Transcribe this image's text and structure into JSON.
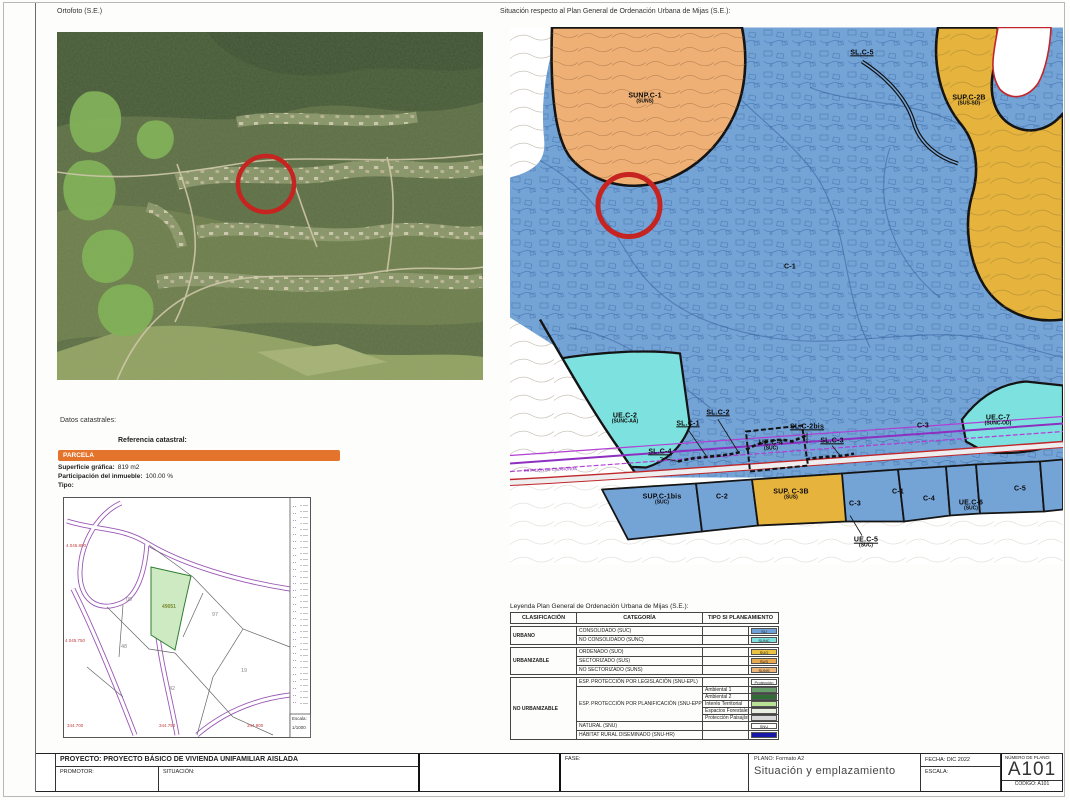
{
  "page": {
    "ortho_caption": "Ortofoto (S.E.)",
    "pgou_caption": "Situación respecto al Plan General de Ordenación Urbana de Mijas (S.E.):"
  },
  "pgou": {
    "corridor_text": "ESTACIÓN DE CALAHONDA",
    "colors": {
      "urban_blue": "#74a3d6",
      "suns_orange": "#efb076",
      "sus_gold": "#e6b33c",
      "sunc_cyan": "#7de2df",
      "marker_red": "#c62420",
      "corridor_purple": "#8d2fc0"
    },
    "labels": [
      {
        "t": "SUNP.C-1",
        "s": "(SUNS)",
        "x": 135,
        "y": 72
      },
      {
        "t": "SL.C-5",
        "x": 352,
        "y": 26,
        "u": 1
      },
      {
        "t": "SUP.C-2B",
        "s": "(SUS-SD)",
        "x": 459,
        "y": 74
      },
      {
        "t": "C-1",
        "x": 280,
        "y": 240
      },
      {
        "t": "UE.C-2",
        "s": "(SUNC-AA)",
        "x": 115,
        "y": 392
      },
      {
        "t": "SL.C-1",
        "x": 178,
        "y": 397,
        "u": 1
      },
      {
        "t": "SL.C-2",
        "x": 208,
        "y": 386,
        "u": 1
      },
      {
        "t": "SL.C-2bis",
        "x": 297,
        "y": 400,
        "u": 1
      },
      {
        "t": "SL.C-3",
        "x": 322,
        "y": 414,
        "u": 1
      },
      {
        "t": "SL.C-4",
        "x": 150,
        "y": 425,
        "u": 1
      },
      {
        "t": "UE.C-4",
        "s": "(SUC)",
        "x": 261,
        "y": 419
      },
      {
        "t": "C-3",
        "x": 413,
        "y": 399
      },
      {
        "t": "UE.C-7",
        "s": "(SUNC-OD)",
        "x": 488,
        "y": 394
      },
      {
        "t": "SUP.C-1bis",
        "s": "(SUC)",
        "x": 152,
        "y": 473
      },
      {
        "t": "C-2",
        "x": 212,
        "y": 470
      },
      {
        "t": "SUP. C-3B",
        "s": "(SUS)",
        "x": 281,
        "y": 468
      },
      {
        "t": "C-3",
        "x": 345,
        "y": 477
      },
      {
        "t": "C-1",
        "x": 388,
        "y": 465
      },
      {
        "t": "C-4",
        "x": 419,
        "y": 472
      },
      {
        "t": "UE.C-6",
        "s": "(SUC)",
        "x": 461,
        "y": 479
      },
      {
        "t": "C-5",
        "x": 510,
        "y": 462
      },
      {
        "t": "UE.C-5",
        "s": "(SUC)",
        "x": 356,
        "y": 516,
        "u": 1
      }
    ]
  },
  "catastro": {
    "section_title": "Datos catastrales:",
    "ref_label": "Referencia catastral:",
    "parcela_header": "PARCELA",
    "fields": [
      {
        "label": "Superficie gráfica:",
        "value": "819 m2"
      },
      {
        "label": "Participación del inmueble:",
        "value": "100.00 %"
      },
      {
        "label": "Tipo:",
        "value": ""
      }
    ],
    "map": {
      "parcel_id": "49051",
      "numbers": [
        {
          "t": "09",
          "x": 66,
          "y": 103
        },
        {
          "t": "97",
          "x": 152,
          "y": 118
        },
        {
          "t": "48",
          "x": 61,
          "y": 150
        },
        {
          "t": "19",
          "x": 181,
          "y": 174
        },
        {
          "t": "42",
          "x": 109,
          "y": 192
        }
      ],
      "left_coords": [
        {
          "t": "4.045.800",
          "x": 3,
          "y": 46
        },
        {
          "t": "4.045.750",
          "x": 2,
          "y": 141
        }
      ],
      "bottom_coords": [
        {
          "t": "344.700",
          "x": 4,
          "y": 226
        },
        {
          "t": "344.750",
          "x": 96,
          "y": 226
        },
        {
          "t": "344.800",
          "x": 184,
          "y": 226
        }
      ],
      "escala_label": "Escala:",
      "escala_value": "1/1000"
    }
  },
  "legend": {
    "title": "Leyenda Plan General de Ordenación Urbana de Mijas (S.E.):",
    "headers": [
      "CLASIFICACIÓN",
      "CATEGORÍA",
      "TIPO SI PLANEAMIENTO"
    ],
    "groups": [
      {
        "name": "URBANO",
        "rows": [
          {
            "cat": "CONSOLIDADO (SUC)",
            "tipos": [
              {
                "chip": "SU",
                "color": "#6fa0d8"
              }
            ]
          },
          {
            "cat": "NO CONSOLIDADO (SUNC)",
            "tipos": [
              {
                "chip": "SUNC",
                "color": "#7de2df"
              }
            ]
          }
        ]
      },
      {
        "name": "URBANIZABLE",
        "rows": [
          {
            "cat": "ORDENADO (SUO)",
            "tipos": [
              {
                "chip": "SUO",
                "color": "#eac23f"
              }
            ]
          },
          {
            "cat": "SECTORIZADO (SUS)",
            "tipos": [
              {
                "chip": "SUS",
                "color": "#e8a84e"
              }
            ]
          },
          {
            "cat": "NO SECTORIZADO (SUNS)",
            "tipos": [
              {
                "chip": "SUNS",
                "color": "#edb577"
              }
            ]
          }
        ]
      },
      {
        "name": "NO URBANIZABLE",
        "rows": [
          {
            "cat": "ESP. PROTECCIÓN POR LEGISLACIÓN (SNU-EPL)",
            "tipos": [
              {
                "chip": "Protección",
                "color": "#ffffff",
                "hatch": "red"
              }
            ]
          },
          {
            "cat": "ESP. PROTECCIÓN POR PLANIFICACIÓN (SNU-EPP)",
            "tipos": [
              {
                "label": "Ambiental 1",
                "color": "#68a06c"
              },
              {
                "label": "Ambiental 2",
                "color": "#2f6b35"
              },
              {
                "label": "Interés Territorial",
                "color": "#b9e295"
              },
              {
                "label": "Espacios Forestales",
                "color": "#e8efe0",
                "hatch": "arrows"
              },
              {
                "label": "Protección Paisajística",
                "color": "#d8d8d8",
                "hatch": "grid"
              }
            ]
          },
          {
            "cat": "NATURAL (SNU)",
            "tipos": [
              {
                "chip": "SNU",
                "color": "#ffffff"
              }
            ]
          },
          {
            "cat": "HÁBITAT RURAL DISEMINADO (SNU-HR)",
            "tipos": [
              {
                "chip": "",
                "color": "#1818a8"
              }
            ]
          }
        ]
      }
    ]
  },
  "titleblock": {
    "proyecto_label": "PROYECTO:  PROYECTO BÁSICO DE VIVIENDA UNIFAMILIAR AISLADA",
    "promotor_label": "PROMOTOR:",
    "situacion_label": "SITUACIÓN:",
    "fase_label": "FASE:",
    "plano_label": "PLANO: Formato A2",
    "plano_title": "Situación y emplazamiento",
    "fecha_label": "FECHA: DIC 2022",
    "escala_label": "ESCALA:",
    "numero_label": "NÚMERO DE PLANO:",
    "numero_value": "A101",
    "codigo_label": "CODIGO:",
    "codigo_value": "A101"
  }
}
